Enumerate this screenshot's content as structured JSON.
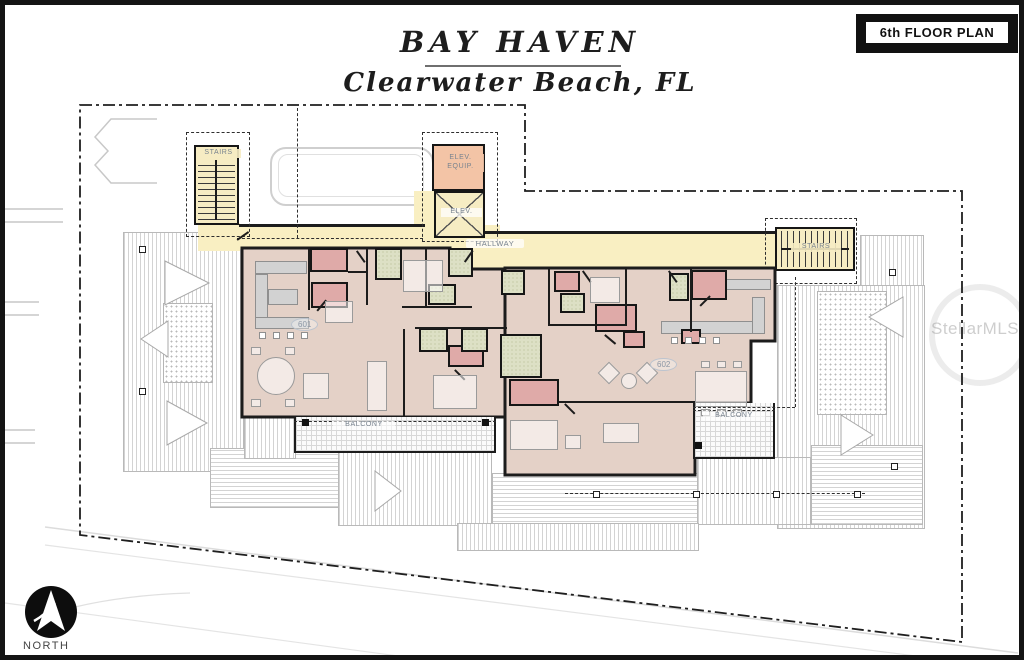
{
  "sheet": {
    "label": "6th FLOOR PLAN"
  },
  "title_block": {
    "title": "BAY HAVEN",
    "subtitle": "Clearwater Beach, FL"
  },
  "north_arrow": {
    "label": "NORTH"
  },
  "watermark": {
    "text": "StellarMLS"
  },
  "rooms": {
    "stairs_left": "STAIRS",
    "stairs_right": "STAIRS",
    "elev_equip_line1": "ELEV.",
    "elev_equip_line2": "EQUIP.",
    "elevator": "ELEV.",
    "hallway": "HALLWAY",
    "balcony_left": "BALCONY",
    "balcony_right": "BALCONY"
  },
  "units": [
    {
      "number": "601"
    },
    {
      "number": "602"
    }
  ],
  "palette": {
    "unit_fill": "#e4d1c7",
    "bathroom_pink": "#dfaaa8",
    "tile_green": "#dde0c5",
    "hallway_yellow": "#f9efc2",
    "stair_cream": "#f6ecc3",
    "elev_equip_salmon": "#f3c4a6",
    "kitchen_gray": "#d2d2d2",
    "wall": "#1c1c1c",
    "boundary": "#1f1f1f"
  }
}
